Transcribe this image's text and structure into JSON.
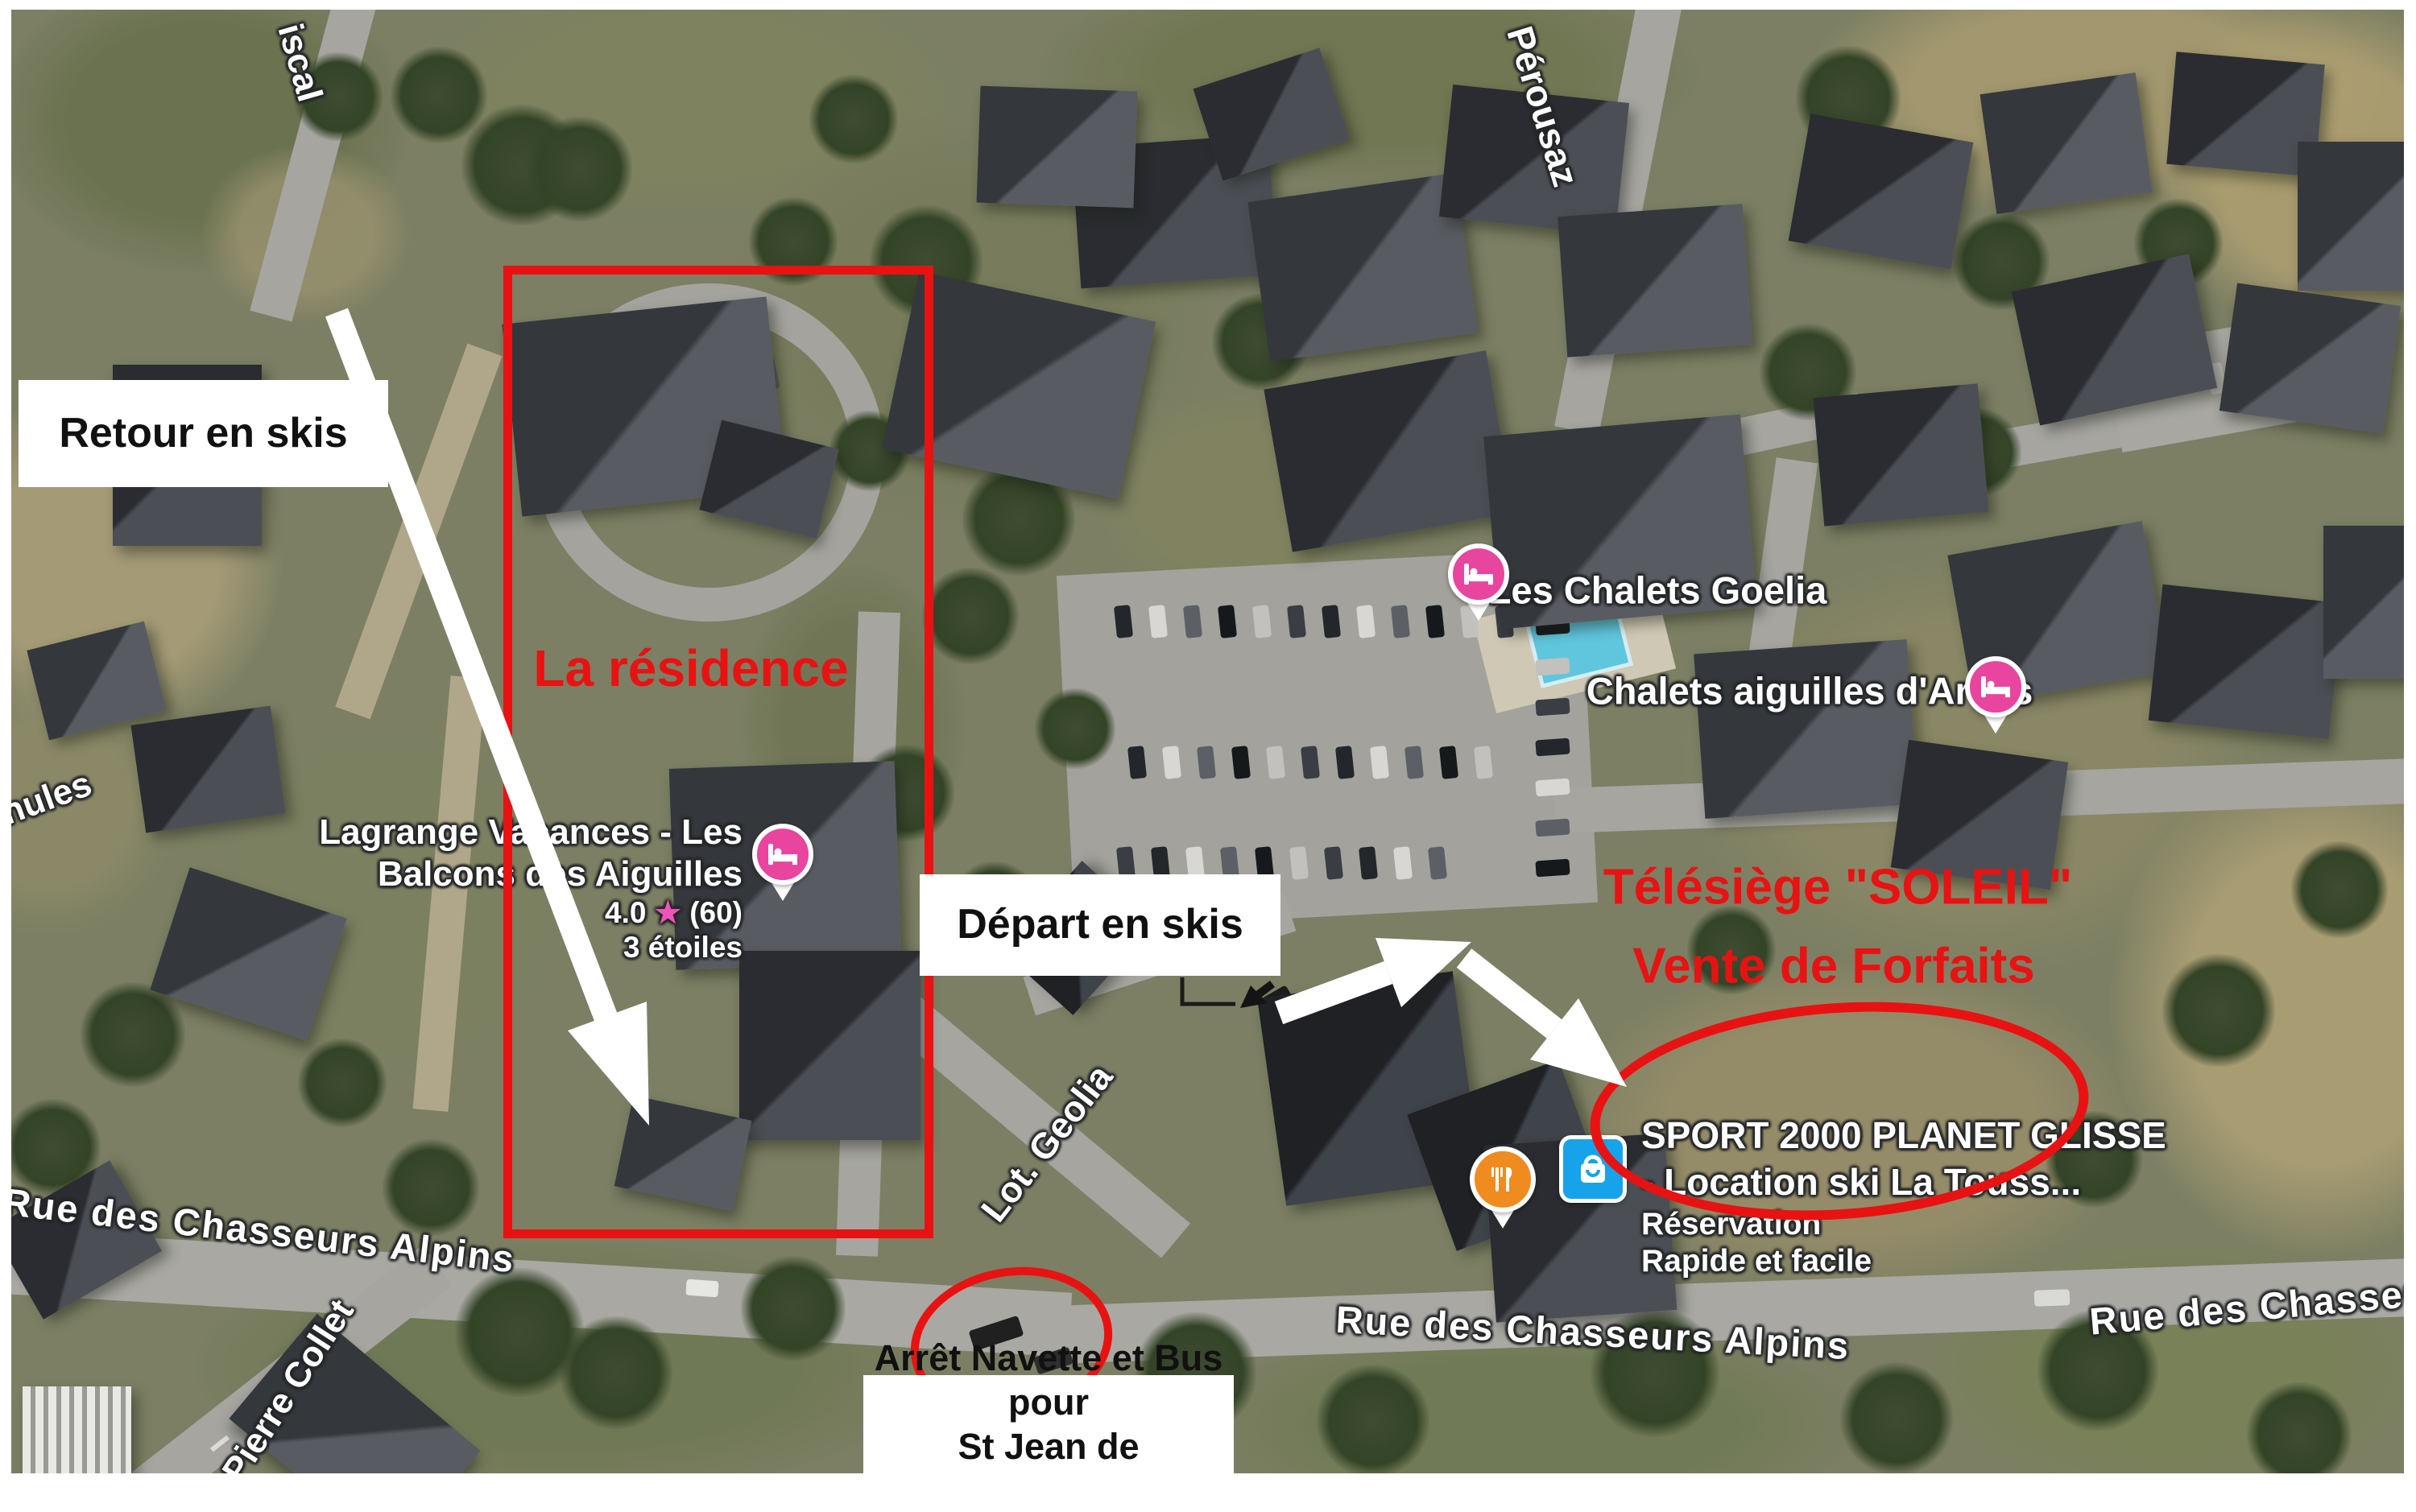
{
  "annotations": {
    "retour_label": "Retour en skis",
    "depart_label": "Départ en skis",
    "residence_label": "La résidence",
    "telesiege_line1": "Télésiège \"SOLEIL\"",
    "telesiege_line2": "Vente de Forfaits",
    "bus_stop_line1": "Arrêt Navette et Bus pour",
    "bus_stop_line2": "St Jean de Maurienne"
  },
  "pois": {
    "lagrange": {
      "name_line1": "Lagrange Vacances - Les",
      "name_line2": "Balcons des Aiguilles",
      "rating": "4.0",
      "star": "★",
      "reviews": "(60)",
      "stars_text": "3 étoiles"
    },
    "goelia": {
      "name": "Les Chalets Goelia"
    },
    "arves": {
      "name": "Chalets aiguilles d'Arves"
    },
    "sport": {
      "line1": "SPORT 2000 PLANET GLISSE",
      "line2": "- Location ski La Touss...",
      "line3": "Réservation",
      "line4": "Rapide et facile"
    }
  },
  "streets": {
    "fiscal": "iscal",
    "perousaz": "Pérousaz",
    "nules": "nules",
    "geolia": "Lot. Geolia",
    "chasseurs_left": "Rue des Chasseurs Alpins",
    "chasseurs_mid": "Rue des Chasseurs Alpins",
    "chasseurs_right": "Rue des Chasseur",
    "pierre_collet": "P. Pierre Collet"
  },
  "colors": {
    "annotation_red": "#e81212",
    "label_box_bg": "#ffffff",
    "label_box_text": "#111111",
    "street_text": "#ffffff",
    "hotel_pin_pink": "#e8459e",
    "restaurant_pin_orange": "#ef8b1f",
    "shopping_icon_blue": "#17a3e9",
    "rating_star_pink": "#ed55bb"
  }
}
